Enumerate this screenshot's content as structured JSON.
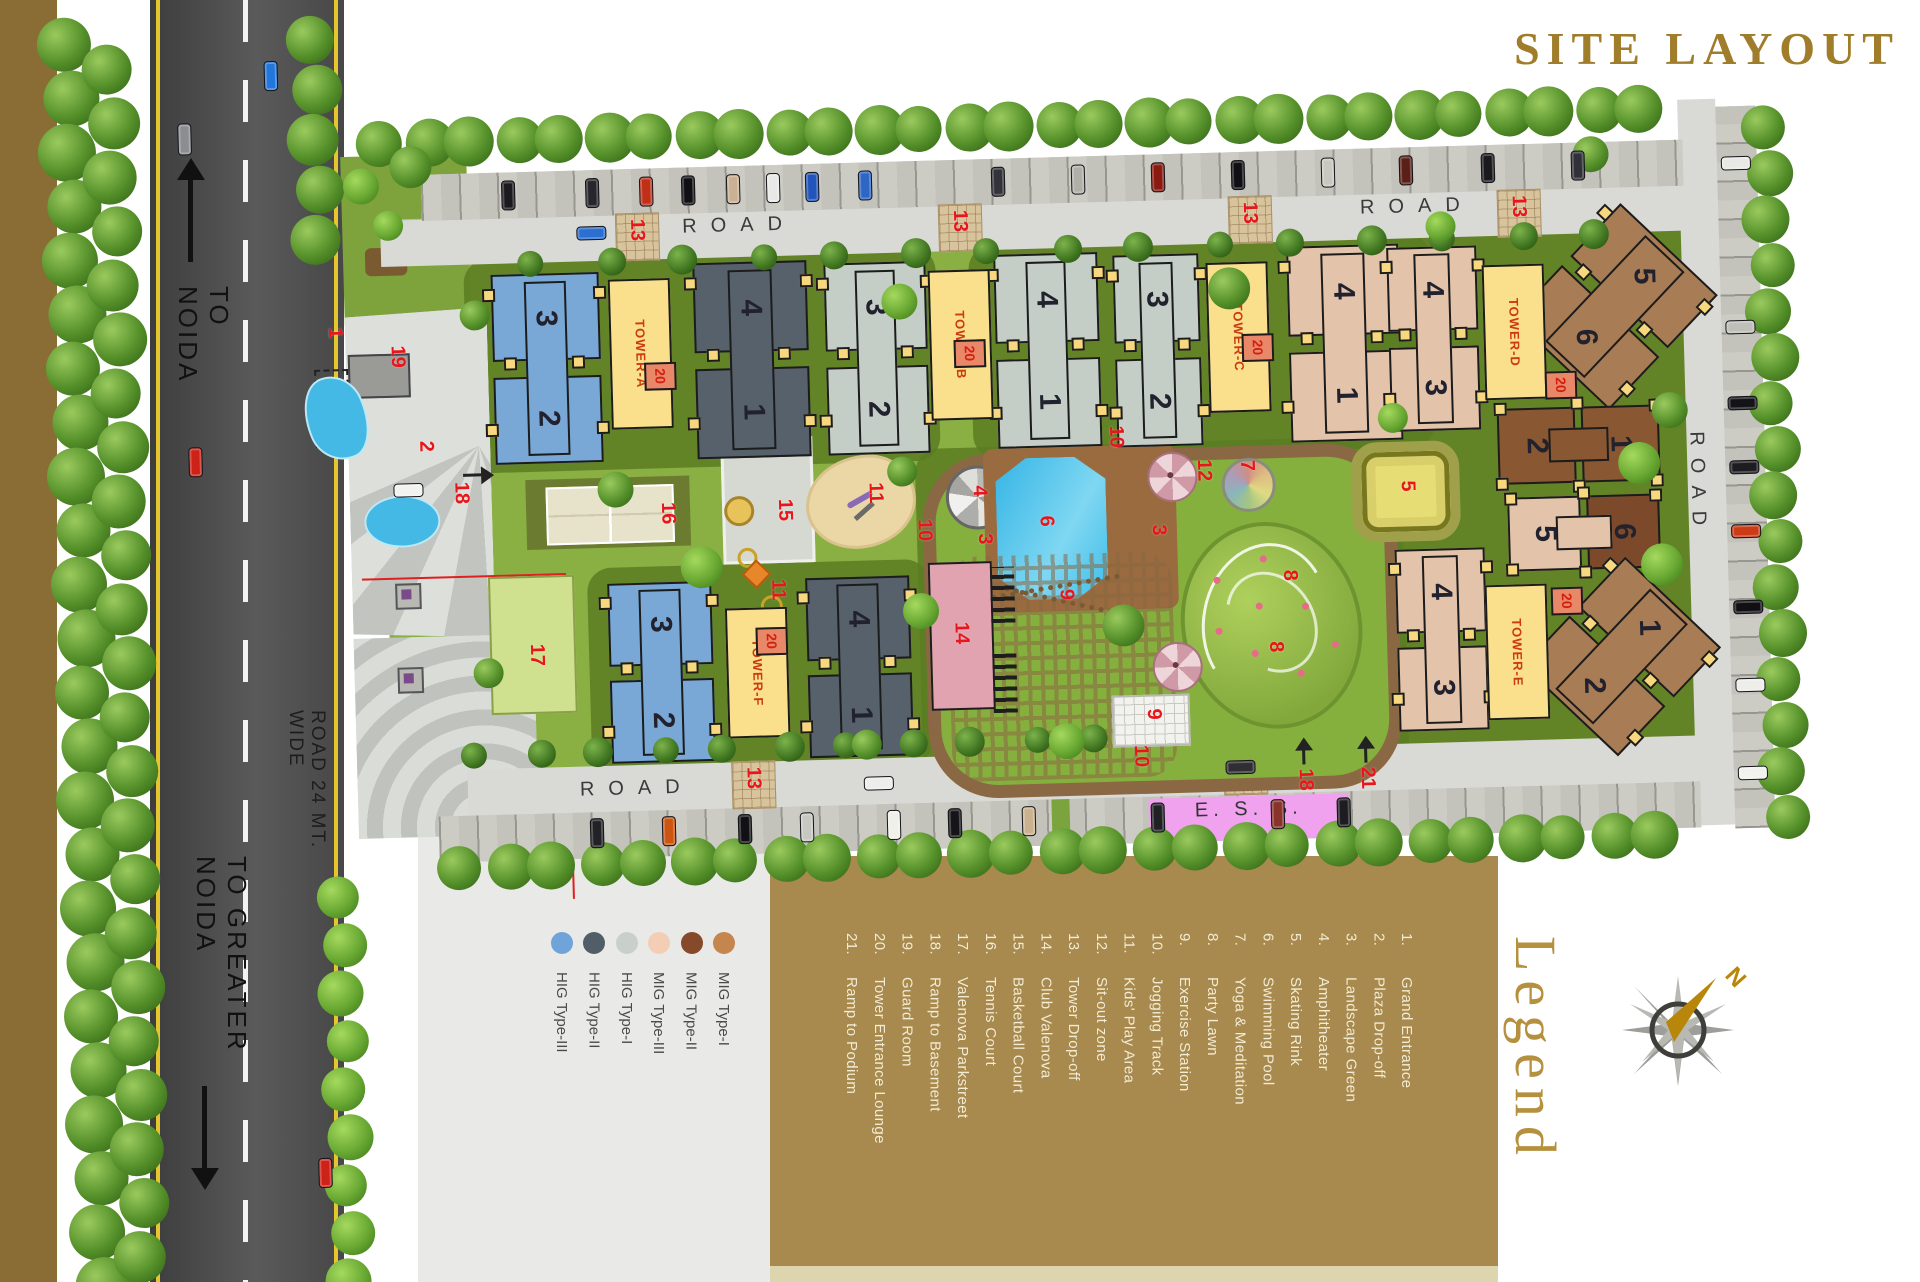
{
  "title": "SITE LAYOUT",
  "legend": {
    "heading": "Legend",
    "items": [
      {
        "num": "1.",
        "label": "Grand Entrance"
      },
      {
        "num": "2.",
        "label": "Plaza Drop-off"
      },
      {
        "num": "3.",
        "label": "Landscape Green"
      },
      {
        "num": "4.",
        "label": "Amphitheater"
      },
      {
        "num": "5.",
        "label": "Skating Rink"
      },
      {
        "num": "6.",
        "label": "Swimming Pool"
      },
      {
        "num": "7.",
        "label": "Yoga & Meditation"
      },
      {
        "num": "8.",
        "label": "Party Lawn"
      },
      {
        "num": "9.",
        "label": "Exercise Station"
      },
      {
        "num": "10.",
        "label": "Jogging Track"
      },
      {
        "num": "11.",
        "label": "Kids' Play Area"
      },
      {
        "num": "12.",
        "label": "Sit-out zone"
      },
      {
        "num": "13.",
        "label": "Tower Drop-off"
      },
      {
        "num": "14.",
        "label": "Club Valenova"
      },
      {
        "num": "15.",
        "label": "Basketball Court"
      },
      {
        "num": "16.",
        "label": "Tennis Court"
      },
      {
        "num": "17.",
        "label": "Valenova Parkstreet"
      },
      {
        "num": "18.",
        "label": "Ramp to Basement"
      },
      {
        "num": "19.",
        "label": "Guard Room"
      },
      {
        "num": "20.",
        "label": "Tower Entrance Lounge"
      },
      {
        "num": "21.",
        "label": "Ramp to Podium"
      }
    ]
  },
  "unit_types": [
    {
      "label": "HIG Type-III",
      "color": "#6fa4da"
    },
    {
      "label": "HIG Type-II",
      "color": "#525e67"
    },
    {
      "label": "HIG Type-I",
      "color": "#c9d0ca"
    },
    {
      "label": "MIG Type-III",
      "color": "#f4cdb5"
    },
    {
      "label": "MIG Type-II",
      "color": "#86492a"
    },
    {
      "label": "MIG Type-I",
      "color": "#c5854e"
    }
  ],
  "compass": {
    "north": "N"
  },
  "road_labels": {
    "to_noida": "TO NOIDA",
    "to_greater_noida": "TO GREATER NOIDA",
    "road_wide": "ROAD 24 MT. WIDE",
    "road": "ROAD",
    "ess": "E. S. S."
  },
  "towers": [
    "TOWER-A",
    "TOWER-B",
    "TOWER-C",
    "TOWER-D",
    "TOWER-E",
    "TOWER-F"
  ],
  "core_badge": "20",
  "palette": {
    "blue": "#79a8d7",
    "slate": "#57616b",
    "gray": "#c4cec7",
    "peach": "#e3c3aa",
    "dbrown": "#7c4a2b",
    "dbrown2": "#8a5733",
    "mbrown": "#a87c54",
    "core_yellow": "#fadf8d",
    "site_green": "#8ab043",
    "dark_green": "#5b7d22",
    "road_gray": "#d9d9d6",
    "asphalt": "#454545",
    "track_brown": "#8a6843",
    "pool_blue": "#3ec2ea",
    "club_pink": "#e0a3af",
    "ess_pink": "#f0a2ee",
    "legend_brown": "#a8894e",
    "band_gold": "#8a6d35",
    "sand": "#ead7a5"
  },
  "site": {
    "buildings": [
      {
        "x": 488,
        "y": 258,
        "w": 126,
        "h": 194,
        "c": "blue",
        "t": "3",
        "b": "2"
      },
      {
        "x": 690,
        "y": 252,
        "w": 132,
        "h": 200,
        "c": "slate",
        "t": "4",
        "b": "1"
      },
      {
        "x": 822,
        "y": 256,
        "w": 118,
        "h": 196,
        "c": "gray",
        "t": "3",
        "b": "2"
      },
      {
        "x": 992,
        "y": 252,
        "w": 120,
        "h": 198,
        "c": "gray",
        "t": "4",
        "b": "1"
      },
      {
        "x": 1112,
        "y": 256,
        "w": 100,
        "h": 196,
        "c": "gray",
        "t": "3",
        "b": "2"
      },
      {
        "x": 1284,
        "y": 252,
        "w": 130,
        "h": 200,
        "c": "peach",
        "t": "4",
        "b": "1"
      },
      {
        "x": 1386,
        "y": 256,
        "w": 104,
        "h": 188,
        "c": "peach",
        "t": "4",
        "b": "3"
      },
      {
        "x": 1542,
        "y": 242,
        "w": 156,
        "h": 162,
        "c": "mbrown",
        "t": "5",
        "b": "6",
        "rot": 45
      },
      {
        "x": 1496,
        "y": 412,
        "w": 168,
        "h": 96,
        "c": "dbrown2",
        "t": "2",
        "b": "1",
        "o": "h"
      },
      {
        "x": 1504,
        "y": 502,
        "w": 158,
        "h": 92,
        "c": "peach",
        "c2": "dbrown",
        "t": "5",
        "b": "6",
        "o": "h"
      },
      {
        "x": 1386,
        "y": 558,
        "w": 104,
        "h": 186,
        "c": "peach",
        "t": "4",
        "b": "3"
      },
      {
        "x": 1540,
        "y": 596,
        "w": 154,
        "h": 154,
        "c": "mbrown",
        "t": "1",
        "b": "2",
        "rot": 45
      },
      {
        "x": 596,
        "y": 570,
        "w": 122,
        "h": 184,
        "c": "blue",
        "t": "3",
        "b": "2"
      },
      {
        "x": 794,
        "y": 570,
        "w": 122,
        "h": 184,
        "c": "slate",
        "t": "4",
        "b": "1"
      }
    ],
    "cores": [
      {
        "x": 614,
        "y": 268,
        "t": 0,
        "px": 648,
        "py": 352
      },
      {
        "x": 934,
        "y": 268,
        "t": 1,
        "px": 958,
        "py": 338
      },
      {
        "x": 1212,
        "y": 268,
        "t": 2,
        "px": 1246,
        "py": 340
      },
      {
        "x": 1488,
        "y": 278,
        "t": 3,
        "px": 1548,
        "py": 386,
        "h": 135
      },
      {
        "x": 1482,
        "y": 598,
        "t": 4,
        "px": 1548,
        "py": 602,
        "h": 135
      },
      {
        "x": 722,
        "y": 600,
        "t": 5,
        "px": 752,
        "py": 620,
        "h": 130
      }
    ],
    "markers": [
      {
        "n": "1",
        "x": 330,
        "y": 308
      },
      {
        "n": "19",
        "x": 392,
        "y": 328
      },
      {
        "n": "2",
        "x": 418,
        "y": 424
      },
      {
        "n": "18",
        "x": 452,
        "y": 466,
        "ar": "r"
      },
      {
        "n": "16",
        "x": 658,
        "y": 492
      },
      {
        "n": "17",
        "x": 523,
        "y": 630
      },
      {
        "n": "15",
        "x": 775,
        "y": 492
      },
      {
        "n": "11",
        "x": 866,
        "y": 478
      },
      {
        "n": "11",
        "x": 766,
        "y": 572
      },
      {
        "n": "10",
        "x": 914,
        "y": 516
      },
      {
        "n": "10",
        "x": 1108,
        "y": 428
      },
      {
        "n": "10",
        "x": 1124,
        "y": 748
      },
      {
        "n": "4",
        "x": 970,
        "y": 484
      },
      {
        "n": "3",
        "x": 974,
        "y": 532
      },
      {
        "n": "3",
        "x": 1148,
        "y": 528
      },
      {
        "n": "6",
        "x": 1036,
        "y": 516
      },
      {
        "n": "14",
        "x": 948,
        "y": 620
      },
      {
        "n": "12",
        "x": 1195,
        "y": 464
      },
      {
        "n": "7",
        "x": 1238,
        "y": 466
      },
      {
        "n": "8",
        "x": 1278,
        "y": 577
      },
      {
        "n": "8",
        "x": 1262,
        "y": 648
      },
      {
        "n": "9",
        "x": 1054,
        "y": 590
      },
      {
        "n": "9",
        "x": 1138,
        "y": 712
      },
      {
        "n": "5",
        "x": 1398,
        "y": 491
      },
      {
        "n": "18",
        "x": 1288,
        "y": 776,
        "ar": "u"
      },
      {
        "n": "21",
        "x": 1350,
        "y": 776,
        "ar": "u"
      }
    ],
    "patches13": [
      {
        "x": 623,
        "y": 202
      },
      {
        "x": 946,
        "y": 202
      },
      {
        "x": 1236,
        "y": 202
      },
      {
        "x": 1505,
        "y": 203
      },
      {
        "x": 724,
        "y": 753
      },
      {
        "x": 1216,
        "y": 753
      }
    ],
    "road_spots": [
      {
        "x": 690,
        "y": 206,
        "o": "h"
      },
      {
        "x": 1368,
        "y": 206,
        "o": "h"
      },
      {
        "x": 572,
        "y": 766,
        "o": "h"
      },
      {
        "x": 1091,
        "y": 766,
        "o": "h"
      },
      {
        "x": 1686,
        "y": 450,
        "o": "v"
      }
    ],
    "cars": [
      {
        "x": 276,
        "y": 40,
        "o": "v",
        "c": "#2277dd"
      },
      {
        "x": 188,
        "y": 100,
        "o": "v",
        "c": "#8b8d90",
        "l": 32
      },
      {
        "x": 190,
        "y": 424,
        "o": "v",
        "c": "#cc2218"
      },
      {
        "x": 300,
        "y": 1138,
        "o": "v",
        "c": "#cc2218"
      },
      {
        "x": 394,
        "y": 466,
        "o": "h",
        "c": "#f2f2ef"
      },
      {
        "x": 584,
        "y": 214,
        "o": "h",
        "c": "#2d6fd0"
      },
      {
        "x": 856,
        "y": 772,
        "o": "h",
        "c": "#ededea"
      },
      {
        "x": 1218,
        "y": 766,
        "o": "h",
        "c": "#2e2e33"
      },
      {
        "x": 510,
        "y": 166,
        "o": "v",
        "c": "#1b1b1f"
      },
      {
        "x": 594,
        "y": 166,
        "o": "v",
        "c": "#26262b"
      },
      {
        "x": 648,
        "y": 166,
        "o": "v",
        "c": "#c03018"
      },
      {
        "x": 690,
        "y": 166,
        "o": "v",
        "c": "#101014"
      },
      {
        "x": 735,
        "y": 166,
        "o": "v",
        "c": "#cbb193"
      },
      {
        "x": 775,
        "y": 166,
        "o": "v",
        "c": "#e8e8e6"
      },
      {
        "x": 814,
        "y": 166,
        "o": "v",
        "c": "#2255bb"
      },
      {
        "x": 867,
        "y": 166,
        "o": "v",
        "c": "#2e66c4"
      },
      {
        "x": 1000,
        "y": 166,
        "o": "v",
        "c": "#33333a"
      },
      {
        "x": 1080,
        "y": 166,
        "o": "v",
        "c": "#b0b0a8"
      },
      {
        "x": 1160,
        "y": 166,
        "o": "v",
        "c": "#8a1a10"
      },
      {
        "x": 1240,
        "y": 166,
        "o": "v",
        "c": "#101014"
      },
      {
        "x": 1330,
        "y": 166,
        "o": "v",
        "c": "#c8c8c0"
      },
      {
        "x": 1408,
        "y": 166,
        "o": "v",
        "c": "#5a2018"
      },
      {
        "x": 1490,
        "y": 166,
        "o": "v",
        "c": "#1a1a1e"
      },
      {
        "x": 1580,
        "y": 166,
        "o": "v",
        "c": "#303038"
      },
      {
        "x": 581,
        "y": 806,
        "o": "v",
        "c": "#222226"
      },
      {
        "x": 653,
        "y": 806,
        "o": "v",
        "c": "#cc5511"
      },
      {
        "x": 729,
        "y": 806,
        "o": "v",
        "c": "#111115"
      },
      {
        "x": 791,
        "y": 806,
        "o": "v",
        "c": "#c8c8c2"
      },
      {
        "x": 878,
        "y": 806,
        "o": "v",
        "c": "#f0f0ea"
      },
      {
        "x": 939,
        "y": 806,
        "o": "v",
        "c": "#151519"
      },
      {
        "x": 1013,
        "y": 806,
        "o": "v",
        "c": "#cbb28f"
      },
      {
        "x": 1142,
        "y": 806,
        "o": "v",
        "c": "#202025"
      },
      {
        "x": 1262,
        "y": 806,
        "o": "v",
        "c": "#88342a"
      },
      {
        "x": 1328,
        "y": 806,
        "o": "v",
        "c": "#1d1d21"
      },
      {
        "x": 1730,
        "y": 176,
        "o": "h",
        "c": "#e8e8e4"
      },
      {
        "x": 1730,
        "y": 340,
        "o": "h",
        "c": "#bfbfb9"
      },
      {
        "x": 1730,
        "y": 416,
        "o": "h",
        "c": "#141418"
      },
      {
        "x": 1730,
        "y": 480,
        "o": "h",
        "c": "#1d1d21"
      },
      {
        "x": 1730,
        "y": 544,
        "o": "h",
        "c": "#cc3b16"
      },
      {
        "x": 1730,
        "y": 620,
        "o": "h",
        "c": "#101014"
      },
      {
        "x": 1730,
        "y": 698,
        "o": "h",
        "c": "#ededea"
      },
      {
        "x": 1730,
        "y": 786,
        "o": "h",
        "c": "#f2f2ee"
      }
    ],
    "tree_strips": [
      {
        "x": 80,
        "y": 18,
        "dx": 0,
        "dy": 54,
        "n": 24,
        "r": 27,
        "c": 1
      },
      {
        "x": 122,
        "y": 44,
        "dx": 0,
        "dy": 54,
        "n": 23,
        "r": 25,
        "c": 1
      },
      {
        "x": 326,
        "y": 20,
        "dx": 0,
        "dy": 50,
        "n": 5,
        "r": 24,
        "c": 1
      },
      {
        "x": 330,
        "y": 878,
        "dx": 0,
        "dy": 48,
        "n": 9,
        "r": 21,
        "c": 2
      },
      {
        "x": 392,
        "y": 126,
        "dx": 45,
        "dy": 0,
        "n": 29,
        "r": 23,
        "c": 1
      },
      {
        "x": 452,
        "y": 852,
        "dx": 46,
        "dy": 0,
        "n": 27,
        "r": 22,
        "c": 1
      },
      {
        "x": 1776,
        "y": 148,
        "dx": 0,
        "dy": 46,
        "n": 16,
        "r": 22,
        "c": 1
      },
      {
        "x": 540,
        "y": 250,
        "dx": 76,
        "dy": 0,
        "n": 15,
        "r": 13,
        "c": 3
      },
      {
        "x": 470,
        "y": 740,
        "dx": 62,
        "dy": 0,
        "n": 11,
        "r": 13,
        "c": 3
      }
    ],
    "tree_spots": [
      [
        480,
        300
      ],
      [
        905,
        298
      ],
      [
        1235,
        294
      ],
      [
        1448,
        238
      ],
      [
        1672,
        428
      ],
      [
        1660,
        582
      ],
      [
        903,
        468
      ],
      [
        918,
        608
      ],
      [
        1120,
        628
      ],
      [
        1395,
        428
      ],
      [
        616,
        478
      ],
      [
        700,
        558
      ],
      [
        484,
        658
      ],
      [
        370,
        168
      ],
      [
        420,
        150
      ],
      [
        396,
        208
      ],
      [
        1600,
        170
      ],
      [
        1640,
        480
      ],
      [
        860,
        740
      ],
      [
        1060,
        742
      ]
    ]
  }
}
